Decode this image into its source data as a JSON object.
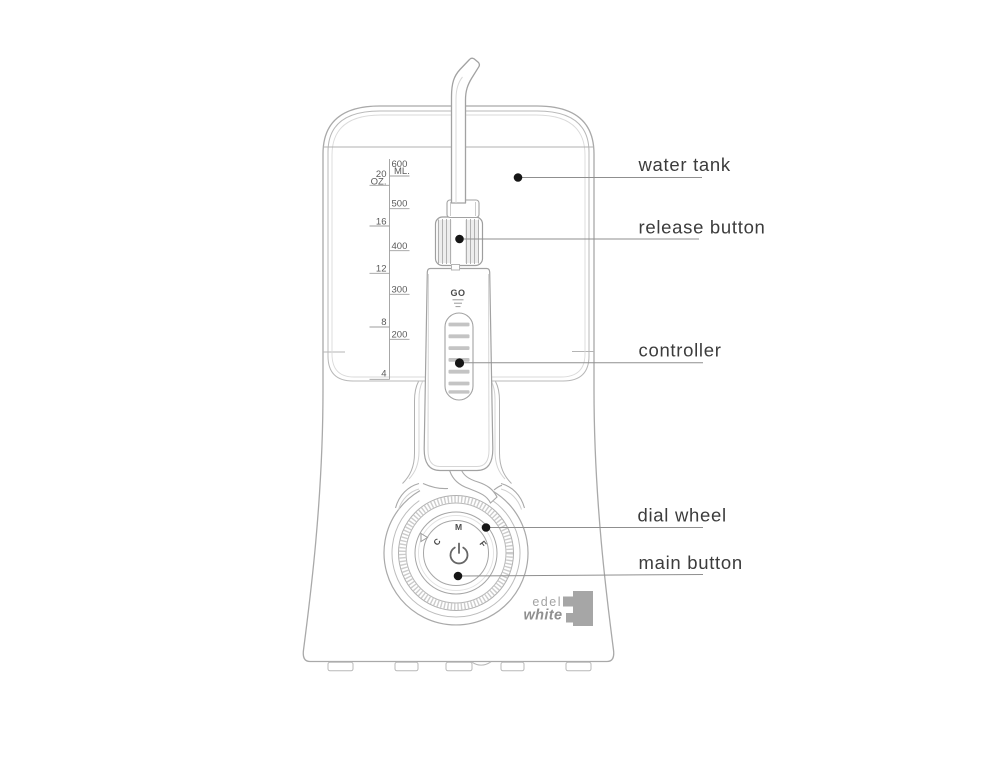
{
  "labels": {
    "water_tank": "water tank",
    "release_button": "release button",
    "controller": "controller",
    "dial_wheel": "dial wheel",
    "main_button": "main button"
  },
  "scale": {
    "ml_unit": "ML.",
    "oz_unit": "OZ.",
    "ml": [
      "600",
      "500",
      "400",
      "300",
      "200"
    ],
    "oz": [
      "20",
      "16",
      "12",
      "8",
      "4"
    ]
  },
  "handle": {
    "go_label": "GO"
  },
  "dial": {
    "letters": [
      "C",
      "M",
      "F"
    ]
  },
  "brand": {
    "edel": "edel",
    "white": "white"
  },
  "colors": {
    "outline": "#a9a9a9",
    "light_line": "#d0d0d0",
    "label_text": "#3c3c3c",
    "scale_text": "#5a5a5a",
    "leader_dot": "#161616",
    "ridge_gray": "#c4c4c4",
    "logo_gray": "#a6a6a6"
  }
}
